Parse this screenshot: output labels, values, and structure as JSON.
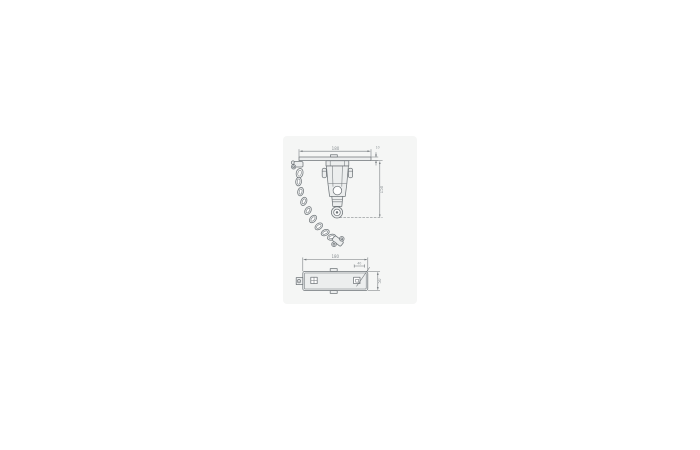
{
  "colors": {
    "line": "#70767a",
    "dim_text": "#8a9094",
    "panel_bg": "#f5f6f5",
    "fill_light": "#eceeee",
    "page_bg": "#ffffff"
  },
  "drawing": {
    "description": "Technical drawing of swing beam hanger with swivel bearing and safety chain, front view and plan view",
    "front_view": {
      "width_label": "180",
      "beam_thickness_label": "10",
      "height_label": "150"
    },
    "plan_view": {
      "width_label": "180",
      "depth_label": "50",
      "hole_label": "40"
    }
  }
}
